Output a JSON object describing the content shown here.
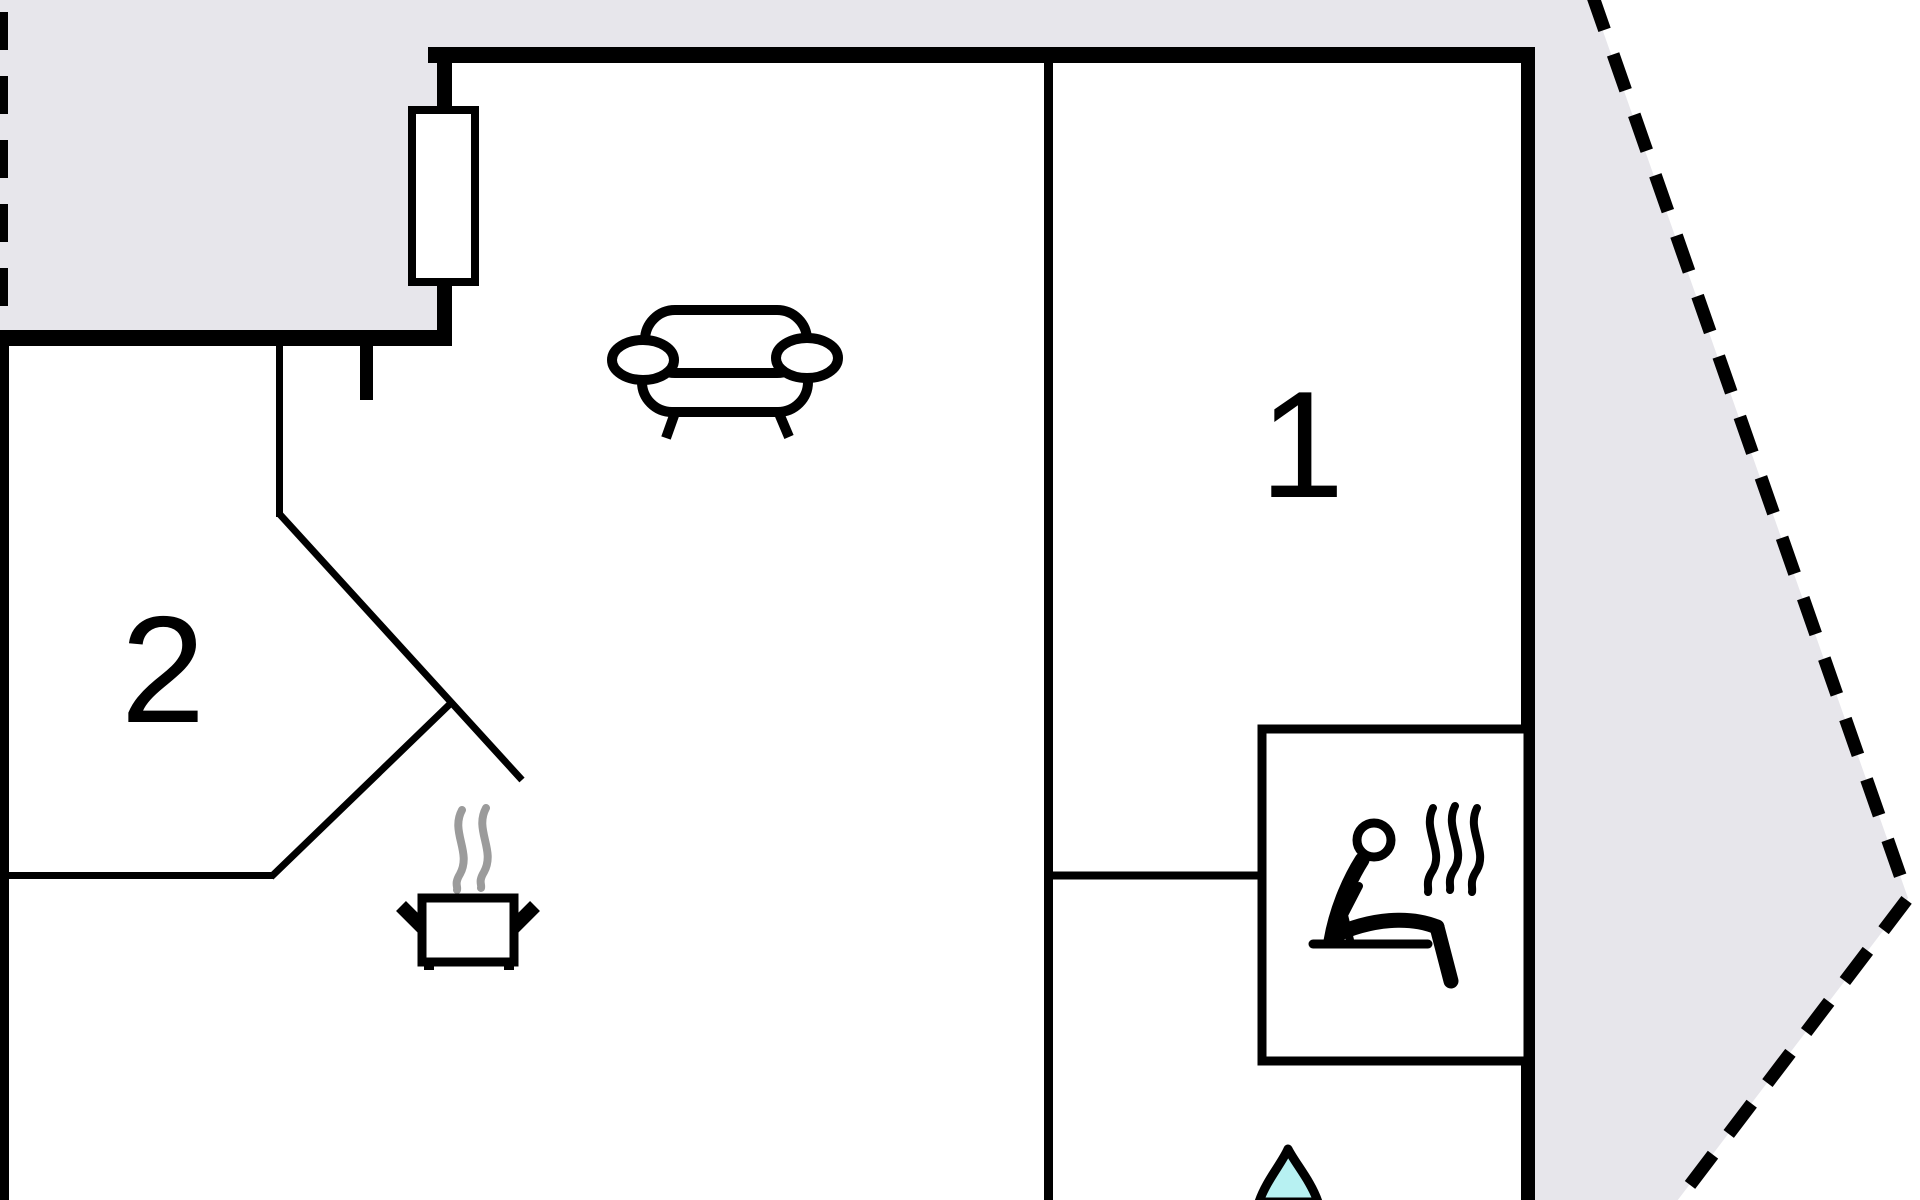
{
  "plan": {
    "title": "floor-plan",
    "rooms": [
      {
        "number": "1"
      },
      {
        "number": "2"
      }
    ],
    "icons": {
      "sofa": "sofa-icon",
      "stove": "cooking-pot-icon",
      "sauna": "sauna-person-icon",
      "water": "water-drop-icon"
    },
    "colors": {
      "outside": "#e7e6eb",
      "wall": "#000000",
      "water": "#b7f1f2",
      "steam": "#9b9b9b"
    }
  }
}
